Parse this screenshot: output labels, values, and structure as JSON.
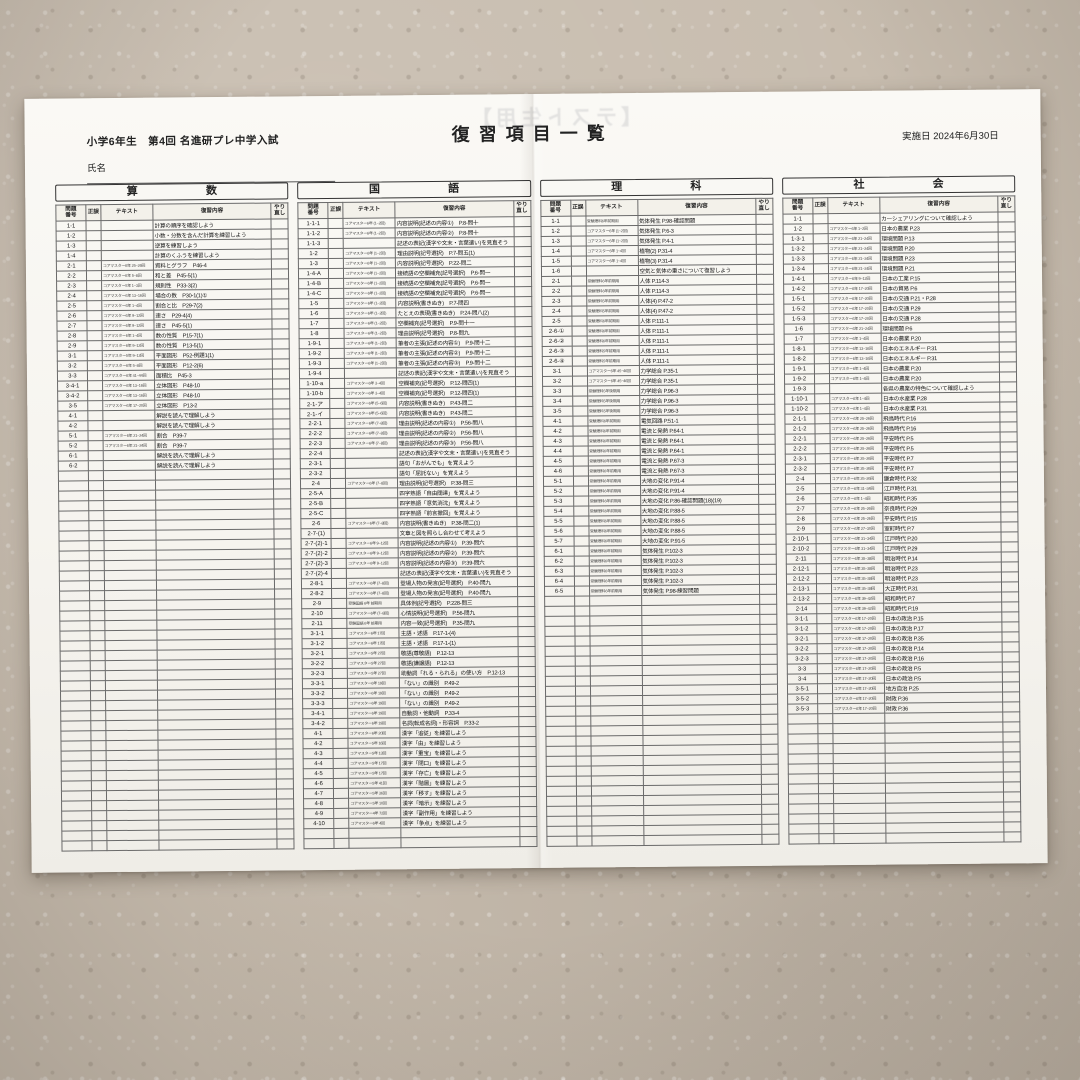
{
  "page": {
    "header_left": "小学6年生　第4回 名進研プレ中学入試",
    "title": "復習項目一覧",
    "date_label": "実施日",
    "date_value": "2024年6月30日",
    "name_label": "氏名",
    "ghost_text": "【テスト生用】"
  },
  "columns": {
    "no": "問題番号",
    "seigo": "正誤",
    "text": "テキスト",
    "content": "復習内容",
    "redo": "やり直し"
  },
  "total_rows_per_table": 63,
  "sections": [
    {
      "title": "算　数",
      "rows": [
        [
          "1-1",
          "",
          "計算の順序を確認しよう"
        ],
        [
          "1-2",
          "",
          "小数・分数を含んだ計算を練習しよう"
        ],
        [
          "1-3",
          "",
          "逆算を練習しよう"
        ],
        [
          "1-4",
          "",
          "計算のくふうを練習しよう"
        ],
        [
          "2-1",
          "コアマスター6年 25~26回",
          "資料とグラフ　P46-4"
        ],
        [
          "2-2",
          "コアマスター6年 5~8回",
          "和と差　P45-5(1)"
        ],
        [
          "2-3",
          "コアマスター5年 1~3回",
          "規則性　P33-3(2)"
        ],
        [
          "2-4",
          "コアマスター6年 13~16回",
          "場合の数　P30-1(1)①"
        ],
        [
          "2-5",
          "コアマスター6年 1~4回",
          "割合と比　P29-7(2)"
        ],
        [
          "2-6",
          "コアマスター6年 9~12回",
          "速さ　P29-4(4)"
        ],
        [
          "2-7",
          "コアマスター6年 9~12回",
          "速さ　P45-5(1)"
        ],
        [
          "2-8",
          "コアマスター6年 1~4回",
          "数の性質　P15-7(1)"
        ],
        [
          "2-9",
          "コアマスター6年 9~12回",
          "数の性質　P13-5(1)"
        ],
        [
          "3-1",
          "コアマスター5年 9~12回",
          "平面図形　P52-例題1(1)"
        ],
        [
          "3-2",
          "コアマスター6年 5~8回",
          "平面図形　P12-2(6)"
        ],
        [
          "3-3",
          "コアマスター6年 41~44回",
          "面積比　P45-3"
        ],
        [
          "3-4-1",
          "コアマスター6年 13~16回",
          "立体図形　P48-10"
        ],
        [
          "3-4-2",
          "コアマスター6年 13~16回",
          "立体図形　P48-10"
        ],
        [
          "3-5",
          "コアマスター6年 17~20回",
          "立体図形　P13-2"
        ],
        [
          "4-1",
          "",
          "解説を読んで理解しよう"
        ],
        [
          "4-2",
          "",
          "解説を読んで理解しよう"
        ],
        [
          "5-1",
          "コアマスター6年 21~24回",
          "割合　P39-7"
        ],
        [
          "5-2",
          "コアマスター6年 21~24回",
          "割合　P39-7"
        ],
        [
          "6-1",
          "",
          "解説を読んで理解しよう"
        ],
        [
          "6-2",
          "",
          "解説を読んで理解しよう"
        ]
      ]
    },
    {
      "title": "国　語",
      "rows": [
        [
          "1-1-1",
          "コアマスター6年 (1~2回)",
          "内容説明(記述の内容①)　P.8-問十"
        ],
        [
          "1-1-2",
          "コアマスター6年 (1~2回)",
          "内容説明(記述の内容②)　P.8-問十"
        ],
        [
          "1-1-3",
          "",
          "記述の表記(漢字や文末・言葉遣い)を見直そう"
        ],
        [
          "1-2",
          "コアマスター6年 (1~2回)",
          "理由説明(記号選択)　P.7-問五(1)"
        ],
        [
          "1-3",
          "コアマスター6年 (1~2回)",
          "内容説明(記号選択)　P.22-問二"
        ],
        [
          "1-4-A",
          "コアマスター6年 (1~2回)",
          "接続語の空欄補充(記号選択)　P.6-問一"
        ],
        [
          "1-4-B",
          "コアマスター6年 (1~2回)",
          "接続語の空欄補充(記号選択)　P.6-問一"
        ],
        [
          "1-4-C",
          "コアマスター6年 (1~2回)",
          "接続語の空欄補充(記号選択)　P.6-問一"
        ],
        [
          "1-5",
          "コアマスター6年 (1~2回)",
          "内容説明(書きぬき)　P.7-問四"
        ],
        [
          "1-6",
          "コアマスター6年 (1~2回)",
          "たとえの表現(書きぬき)　P.24-問八(2)"
        ],
        [
          "1-7",
          "コアマスター6年 (1~2回)",
          "空欄補充(記号選択)　P.9-問十一"
        ],
        [
          "1-8",
          "コアマスター6年 (1~2回)",
          "理由説明(記号選択)　P.8-問九"
        ],
        [
          "1-9-1",
          "コアマスター6年 (1~2回)",
          "筆者の主張(記述の内容①)　P.9-問十二"
        ],
        [
          "1-9-2",
          "コアマスター6年 (1~2回)",
          "筆者の主張(記述の内容②)　P.9-問十二"
        ],
        [
          "1-9-3",
          "コアマスター6年 (1~2回)",
          "筆者の主張(記述の内容③)　P.9-問十二"
        ],
        [
          "1-9-4",
          "",
          "記述の表記(漢字や文末・言葉遣い)を見直そう"
        ],
        [
          "1-10-a",
          "コアマスター6年 3~4回",
          "空欄補充(記号選択)　P.12-問四(1)"
        ],
        [
          "1-10-b",
          "コアマスター6年 3~4回",
          "空欄補充(記号選択)　P.12-問四(1)"
        ],
        [
          "2-1-ア",
          "コアマスター6年 (5~6回)",
          "内容説明(書きぬき)　P.43-問二"
        ],
        [
          "2-1-イ",
          "コアマスター6年 (5~6回)",
          "内容説明(書きぬき)　P.43-問二"
        ],
        [
          "2-2-1",
          "コアマスター6年 (7~8回)",
          "理由説明(記述の内容①)　P.56-問八"
        ],
        [
          "2-2-2",
          "コアマスター6年 (7~8回)",
          "理由説明(記述の内容②)　P.56-問八"
        ],
        [
          "2-2-3",
          "コアマスター6年 (7~8回)",
          "理由説明(記述の内容③)　P.56-問八"
        ],
        [
          "2-2-4",
          "",
          "記述の表記(漢字や文末・言葉遣い)を見直そう"
        ],
        [
          "2-3-1",
          "",
          "語句「おがんでも」を覚えよう"
        ],
        [
          "2-3-2",
          "",
          "語句「屈託ない」を覚えよう"
        ],
        [
          "2-4",
          "コアマスター6年 (7~8回)",
          "理由説明(記号選択)　P.38-問三"
        ],
        [
          "2-5-A",
          "",
          "四字熟語「自由闊達」を覚えよう"
        ],
        [
          "2-5-B",
          "",
          "四字熟語「意気消沈」を覚えよう"
        ],
        [
          "2-5-C",
          "",
          "四字熟語「前言撤回」を覚えよう"
        ],
        [
          "2-6",
          "コアマスター6年 (7~8回)",
          "内容説明(書きぬき)　P.38-問二(1)"
        ],
        [
          "2-7-(1)",
          "",
          "文章と図を照らし合わせて考えよう"
        ],
        [
          "2-7-(2)-1",
          "コアマスター6年 9~12回",
          "内容説明(記述の内容①)　P.39-問六"
        ],
        [
          "2-7-(2)-2",
          "コアマスター6年 9~12回",
          "内容説明(記述の内容②)　P.39-問六"
        ],
        [
          "2-7-(2)-3",
          "コアマスター6年 9~12回",
          "内容説明(記述の内容③)　P.39-問六"
        ],
        [
          "2-7-(2)-4",
          "",
          "記述の表記(漢字や文末・言葉遣い)を見直そう"
        ],
        [
          "2-8-1",
          "コアマスター6年 (7~8回)",
          "登場人物の発言(記号選択)　P.40-問九"
        ],
        [
          "2-8-2",
          "コアマスター6年 (7~8回)",
          "登場人物の発言(記号選択)　P.40-問九"
        ],
        [
          "2-9",
          "受験国語 6年 前期用",
          "具体例(記号選択)　P.228-問三"
        ],
        [
          "2-10",
          "コアマスター6年 (7~8回)",
          "心情説明(記号選択)　P.56-問九"
        ],
        [
          "2-11",
          "受験国語 6年 前期用",
          "内容一致(記号選択)　P.35-問九"
        ],
        [
          "3-1-1",
          "コアマスター6年 17回",
          "主語・述語　P.17-1-(4)"
        ],
        [
          "3-1-2",
          "コアマスター6年 17回",
          "主語・述語　P.17-1-(1)"
        ],
        [
          "3-2-1",
          "コアマスター5年 27回",
          "敬語(尊敬語)　P.12-13"
        ],
        [
          "3-2-2",
          "コアマスター5年 27回",
          "敬語(謙譲語)　P.12-13"
        ],
        [
          "3-2-3",
          "コアマスター5年 27回",
          "助動詞「れる・られる」の使い方　P.12-13"
        ],
        [
          "3-3-1",
          "コアマスター6年 19回",
          "「ない」の識別　P.49-2"
        ],
        [
          "3-3-2",
          "コアマスター6年 19回",
          "「ない」の識別　P.49-2"
        ],
        [
          "3-3-3",
          "コアマスター6年 19回",
          "「ない」の識別　P.49-2"
        ],
        [
          "3-4-1",
          "コアマスター6年 19回",
          "自動詞・他動詞　P.33-4"
        ],
        [
          "3-4-2",
          "コアマスター6年 19回",
          "名詞(転成名詞)・形容詞　P.33-2"
        ],
        [
          "4-1",
          "コアマスター6年 20回",
          "漢字「追従」を練習しよう"
        ],
        [
          "4-2",
          "コアマスター5年 16回",
          "漢字「由」を練習しよう"
        ],
        [
          "4-3",
          "コアマスター5年 13回",
          "漢字「重宝」を練習しよう"
        ],
        [
          "4-4",
          "コアマスター5年 17回",
          "漢字「閉口」を練習しよう"
        ],
        [
          "4-5",
          "コアマスター5年 17回",
          "漢字「存亡」を練習しよう"
        ],
        [
          "4-6",
          "コアマスター5年 41回",
          "漢字「階層」を練習しよう"
        ],
        [
          "4-7",
          "コアマスター5年 36回",
          "漢字「移す」を練習しよう"
        ],
        [
          "4-8",
          "コアマスター5年 10回",
          "漢字「暗示」を練習しよう"
        ],
        [
          "4-9",
          "コアマスター4年 72回",
          "漢字「副作用」を練習しよう"
        ],
        [
          "4-10",
          "コアマスター6年 4回",
          "漢字「争点」を練習しよう"
        ]
      ]
    },
    {
      "title": "理　科",
      "rows": [
        [
          "1-1",
          "受験理科6年前期用",
          "気体発生 P.98-確認問題"
        ],
        [
          "1-2",
          "コアマスター6年 (1~2回)",
          "気体発生 P.6-3"
        ],
        [
          "1-3",
          "コアマスター6年 (1~2回)",
          "気体発生 P.4-1"
        ],
        [
          "1-4",
          "コアマスター6年 1~4回",
          "植物(2) P.31-4"
        ],
        [
          "1-5",
          "コアマスター6年 1~4回",
          "植物(3) P.31-4"
        ],
        [
          "1-6",
          "",
          "空気と気体の重さについて復習しよう"
        ],
        [
          "2-1",
          "受験理科6年前期用",
          "人体 P.114-3"
        ],
        [
          "2-2",
          "受験理科6年前期用",
          "人体 P.114-3"
        ],
        [
          "2-3",
          "受験理科5年前期用",
          "人体(4) P.47-2"
        ],
        [
          "2-4",
          "受験理科5年前期用",
          "人体(4) P.47-2"
        ],
        [
          "2-5",
          "受験理科6年前期用",
          "人体 P.111-1"
        ],
        [
          "2-6-①",
          "受験理科6年前期用",
          "人体 P.111-1"
        ],
        [
          "2-6-②",
          "受験理科6年前期用",
          "人体 P.111-1"
        ],
        [
          "2-6-③",
          "受験理科5年前期用",
          "人体 P.111-1"
        ],
        [
          "2-6-④",
          "受験理科5年前期用",
          "人体 P.111-1"
        ],
        [
          "3-1",
          "コアマスター6年 45~46回",
          "力学総合 P.35-1"
        ],
        [
          "3-2",
          "コアマスター6年 45~46回",
          "力学総合 P.35-1"
        ],
        [
          "3-3",
          "受験理科5年後期用",
          "力学総合 P.96-3"
        ],
        [
          "3-4",
          "受験理科5年後期用",
          "力学総合 P.96-3"
        ],
        [
          "3-5",
          "受験理科5年後期用",
          "力学総合 P.96-3"
        ],
        [
          "4-1",
          "受験理科6年前期用",
          "電気回路 P.51-1"
        ],
        [
          "4-2",
          "受験理科6年前期用",
          "電流と発熱 P.64-1"
        ],
        [
          "4-3",
          "受験理科6年前期用",
          "電流と発熱 P.64-1"
        ],
        [
          "4-4",
          "受験理科6年前期用",
          "電流と発熱 P.64-1"
        ],
        [
          "4-5",
          "受験理科6年前期用",
          "電流と発熱 P.67-3"
        ],
        [
          "4-6",
          "受験理科6年前期用",
          "電流と発熱 P.67-3"
        ],
        [
          "5-1",
          "受験理科6年前期用",
          "大地の変化 P.91-4"
        ],
        [
          "5-2",
          "受験理科6年前期用",
          "大地の変化 P.91-4"
        ],
        [
          "5-3",
          "受験理科6年前期用",
          "大地の変化 P.86-確認問題(18)(19)"
        ],
        [
          "5-4",
          "受験理科6年前期用",
          "大地の変化 P.88-5"
        ],
        [
          "5-5",
          "受験理科6年前期用",
          "大地の変化 P.88-5"
        ],
        [
          "5-6",
          "受験理科6年前期用",
          "大地の変化 P.88-5"
        ],
        [
          "5-7",
          "受験理科6年前期用",
          "大地の変化 P.91-5"
        ],
        [
          "6-1",
          "受験理科6年前期用",
          "気体発生 P.102-3"
        ],
        [
          "6-2",
          "受験理科6年前期用",
          "気体発生 P.102-3"
        ],
        [
          "6-3",
          "受験理科6年前期用",
          "気体発生 P.102-3"
        ],
        [
          "6-4",
          "受験理科6年前期用",
          "気体発生 P.102-3"
        ],
        [
          "6-5",
          "受験理科6年前期用",
          "気体発生 P.98-練習問題"
        ]
      ]
    },
    {
      "title": "社　会",
      "rows": [
        [
          "1-1",
          "",
          "カーシェアリングについて確認しよう"
        ],
        [
          "1-2",
          "コアマスター6年 1~2回",
          "日本の農業 P.23"
        ],
        [
          "1-3-1",
          "コアマスター6年 21~24回",
          "環境問題 P.13"
        ],
        [
          "1-3-2",
          "コアマスター6年 21~24回",
          "環境問題 P.20"
        ],
        [
          "1-3-3",
          "コアマスター6年 21~24回",
          "環境問題 P.23"
        ],
        [
          "1-3-4",
          "コアマスター6年 21~24回",
          "環境問題 P.21"
        ],
        [
          "1-4-1",
          "コアマスター6年 9~12回",
          "日本の工業 P.15"
        ],
        [
          "1-4-2",
          "コアマスター6年 17~20回",
          "日本の貿易 P.6"
        ],
        [
          "1-5-1",
          "コアマスター6年 17~20回",
          "日本の交通 P.21・P.28"
        ],
        [
          "1-5-2",
          "コアマスター6年 17~20回",
          "日本の交通 P.29"
        ],
        [
          "1-5-3",
          "コアマスター6年 17~20回",
          "日本の交通 P.28"
        ],
        [
          "1-6",
          "コアマスター6年 21~24回",
          "環境問題 P.6"
        ],
        [
          "1-7",
          "コアマスター6年 1~4回",
          "日本の農業 P.20"
        ],
        [
          "1-8-1",
          "コアマスター6年 13~16回",
          "日本のエネルギー P.31"
        ],
        [
          "1-8-2",
          "コアマスター6年 13~16回",
          "日本のエネルギー P.31"
        ],
        [
          "1-9-1",
          "コアマスター6年 1~4回",
          "日本の農業 P.20"
        ],
        [
          "1-9-2",
          "コアマスター6年 1~4回",
          "日本の農業 P.20"
        ],
        [
          "1-9-3",
          "",
          "各県の農業の特色について確認しよう"
        ],
        [
          "1-10-1",
          "コアマスター6年 1~4回",
          "日本の水産業 P.28"
        ],
        [
          "1-10-2",
          "コアマスター6年 1~4回",
          "日本の水産業 P.31"
        ],
        [
          "2-1-1",
          "コアマスター6年 25~26回",
          "飛鳥時代 P.16"
        ],
        [
          "2-1-2",
          "コアマスター6年 25~26回",
          "飛鳥時代 P.16"
        ],
        [
          "2-2-1",
          "コアマスター6年 25~26回",
          "平安時代 P.5"
        ],
        [
          "2-2-2",
          "コアマスター6年 25~26回",
          "平安時代 P.5"
        ],
        [
          "2-3-1",
          "コアマスター6年 25~26回",
          "平安時代 P.7"
        ],
        [
          "2-3-2",
          "コアマスター6年 25~26回",
          "平安時代 P.7"
        ],
        [
          "2-4",
          "コアマスター6年 25~26回",
          "鎌倉時代 P.32"
        ],
        [
          "2-5",
          "コアマスター6年 31~34回",
          "江戸時代 P.31"
        ],
        [
          "2-6",
          "コアマスター6年 1~4回",
          "昭和時代 P.35"
        ],
        [
          "2-7",
          "コアマスター6年 25~26回",
          "奈良時代 P.29"
        ],
        [
          "2-8",
          "コアマスター6年 25~26回",
          "平安時代 P.15"
        ],
        [
          "2-9",
          "コアマスター6年 27~30回",
          "室町時代 P.7"
        ],
        [
          "2-10-1",
          "コアマスター6年 31~34回",
          "江戸時代 P.20"
        ],
        [
          "2-10-2",
          "コアマスター6年 31~34回",
          "江戸時代 P.29"
        ],
        [
          "2-11",
          "コアマスター6年 35~38回",
          "明治時代 P.14"
        ],
        [
          "2-12-1",
          "コアマスター6年 35~38回",
          "明治時代 P.23"
        ],
        [
          "2-12-2",
          "コアマスター6年 35~38回",
          "明治時代 P.23"
        ],
        [
          "2-13-1",
          "コアマスター6年 35~38回",
          "大正時代 P.31"
        ],
        [
          "2-13-2",
          "コアマスター6年 39~42回",
          "昭和時代 P.7"
        ],
        [
          "2-14",
          "コアマスター6年 39~42回",
          "昭和時代 P.19"
        ],
        [
          "3-1-1",
          "コアマスター6年 17~20回",
          "日本の政治 P.15"
        ],
        [
          "3-1-2",
          "コアマスター6年 17~20回",
          "日本の政治 P.17"
        ],
        [
          "3-2-1",
          "コアマスター6年 17~20回",
          "日本の政治 P.35"
        ],
        [
          "3-2-2",
          "コアマスター6年 17~20回",
          "日本の政治 P.14"
        ],
        [
          "3-2-3",
          "コアマスター6年 17~20回",
          "日本の政治 P.16"
        ],
        [
          "3-3",
          "コアマスター6年 17~20回",
          "日本の政治 P.5"
        ],
        [
          "3-4",
          "コアマスター6年 17~20回",
          "日本の政治 P.5"
        ],
        [
          "3-5-1",
          "コアマスター6年 17~20回",
          "地方自治 P.25"
        ],
        [
          "3-5-2",
          "コアマスター6年 17~20回",
          "財政 P.36"
        ],
        [
          "3-5-3",
          "コアマスター6年 17~20回",
          "財政 P.36"
        ]
      ]
    }
  ]
}
